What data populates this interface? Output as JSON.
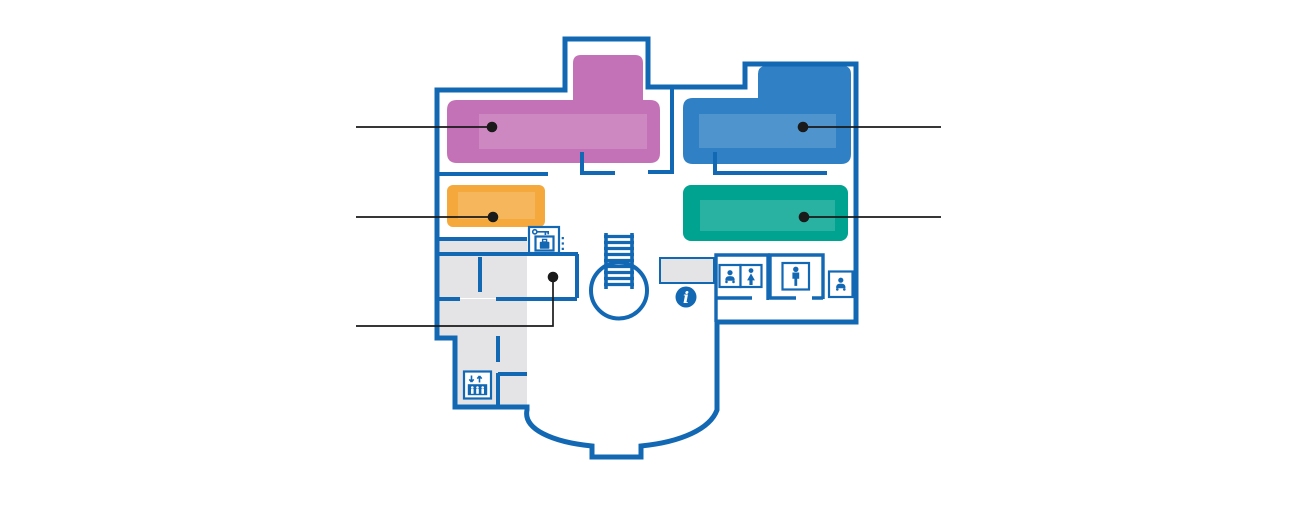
{
  "colors": {
    "background": "#ffffff",
    "wall": "#1368b4",
    "room_pink": "#c472b7",
    "room_blue": "#2f80c4",
    "room_orange": "#f5a93d",
    "room_teal": "#00a390",
    "room_gray": "#e4e4e6",
    "inner_overlay": "rgba(255,255,255,0.16)",
    "callout": "#1a1a1a"
  },
  "floor_plan": {
    "type": "building-floor-plan",
    "rooms": [
      {
        "id": "room-pink",
        "label": ""
      },
      {
        "id": "room-blue",
        "label": ""
      },
      {
        "id": "room-orange",
        "label": ""
      },
      {
        "id": "room-teal",
        "label": ""
      },
      {
        "id": "room-coat-check",
        "label": ""
      }
    ],
    "callouts": [
      {
        "target": "room-pink",
        "side": "left",
        "label": ""
      },
      {
        "target": "room-blue",
        "side": "right",
        "label": ""
      },
      {
        "target": "room-orange",
        "side": "left",
        "label": ""
      },
      {
        "target": "room-teal",
        "side": "right",
        "label": ""
      },
      {
        "target": "room-coat-check",
        "side": "left",
        "label": ""
      }
    ],
    "icons": [
      {
        "name": "coat-check-icon"
      },
      {
        "name": "staircase-icon"
      },
      {
        "name": "info-icon",
        "glyph": "i"
      },
      {
        "name": "baby-changing-icon"
      },
      {
        "name": "womens-restroom-icon"
      },
      {
        "name": "mens-restroom-icon"
      },
      {
        "name": "family-restroom-icon"
      },
      {
        "name": "elevator-icon"
      }
    ],
    "info_glyph": "i"
  }
}
